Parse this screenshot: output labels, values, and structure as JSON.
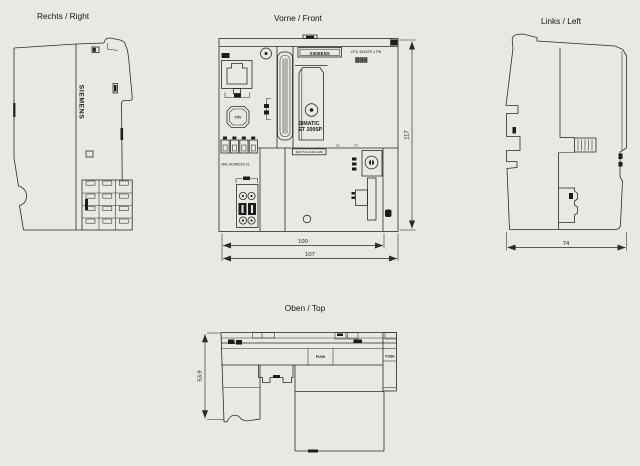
{
  "colors": {
    "background": "#e9e8e3",
    "line": "#2a2a28",
    "dark_fill": "#1c1c1c"
  },
  "views": {
    "right": {
      "title": "Rechts / Right",
      "brand_vertical": "SIEMENS"
    },
    "front": {
      "title": "Vorne / Front",
      "brand_plate": "SIEMENS",
      "cpu_type_label": "CPU 1510SP-1 PN",
      "product_name_line1": "SIMATIC",
      "product_name_line2": "ET 200SP",
      "mac_address_label": "MAC ADDRESS X1",
      "article_number_label": "6ES7 510-1DJ01-0AB0",
      "tuv_mark": "TÜV",
      "port_label_x1": "X1",
      "port_label_p1": "P1",
      "dimensions": {
        "height_mm": "117",
        "width_inner_mm": "100",
        "width_outer_mm": "107"
      }
    },
    "left": {
      "title": "Links / Left",
      "dimensions": {
        "depth_mm": "74"
      }
    },
    "top": {
      "title": "Oben / Top",
      "push_button_1": "PUSH",
      "push_button_2": "PUSH",
      "dimensions": {
        "depth_mm": "53.9"
      }
    }
  }
}
